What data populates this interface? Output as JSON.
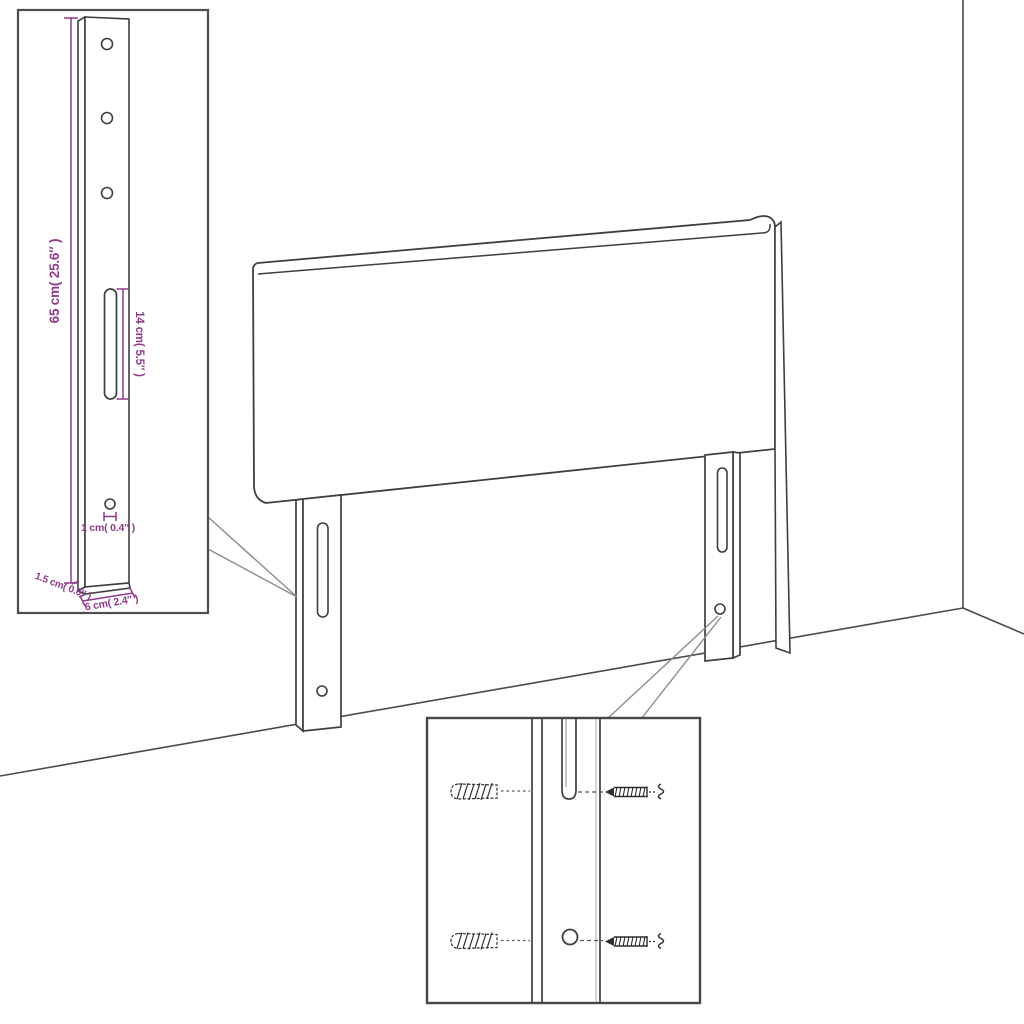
{
  "diagram": {
    "type": "product-dimension-line-drawing",
    "subject": "upholstered headboard with two mounting legs, shown against a wall corner",
    "colors": {
      "background": "#ffffff",
      "outline": "#3f3f3f",
      "inset_border": "#4d4d4d",
      "callout": "#8c8c8c",
      "dimension": "#8e3a8a",
      "hardware": "#2e2e2e"
    },
    "insets": {
      "leg_detail": "enlarged mounting leg with three holes, long slot, small hole",
      "hardware_detail": "wall plugs and screws aligned to leg slot and hole"
    },
    "dimensions": {
      "leg_height": "65 cm( 25.6″ )",
      "slot_length": "14 cm( 5.5″ )",
      "hole_diameter": "1 cm( 0.4″ )",
      "leg_depth": "1.5 cm( 0.6″ )",
      "leg_width": "6 cm( 2.4″ )"
    }
  }
}
